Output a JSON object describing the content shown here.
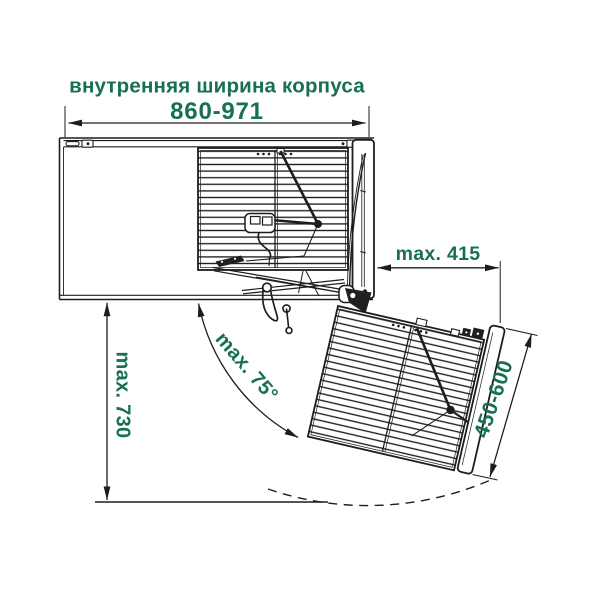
{
  "diagram": {
    "title": "внутренняя ширина корпуса",
    "dimensions": {
      "inner_width": "860-971",
      "max_offset": "max. 415",
      "max_height": "max. 730",
      "max_angle": "max. 75°",
      "front_width": "450-600"
    },
    "colors": {
      "label_green": "#176F55",
      "line_black": "#1d1d1b",
      "background": "#ffffff"
    }
  }
}
